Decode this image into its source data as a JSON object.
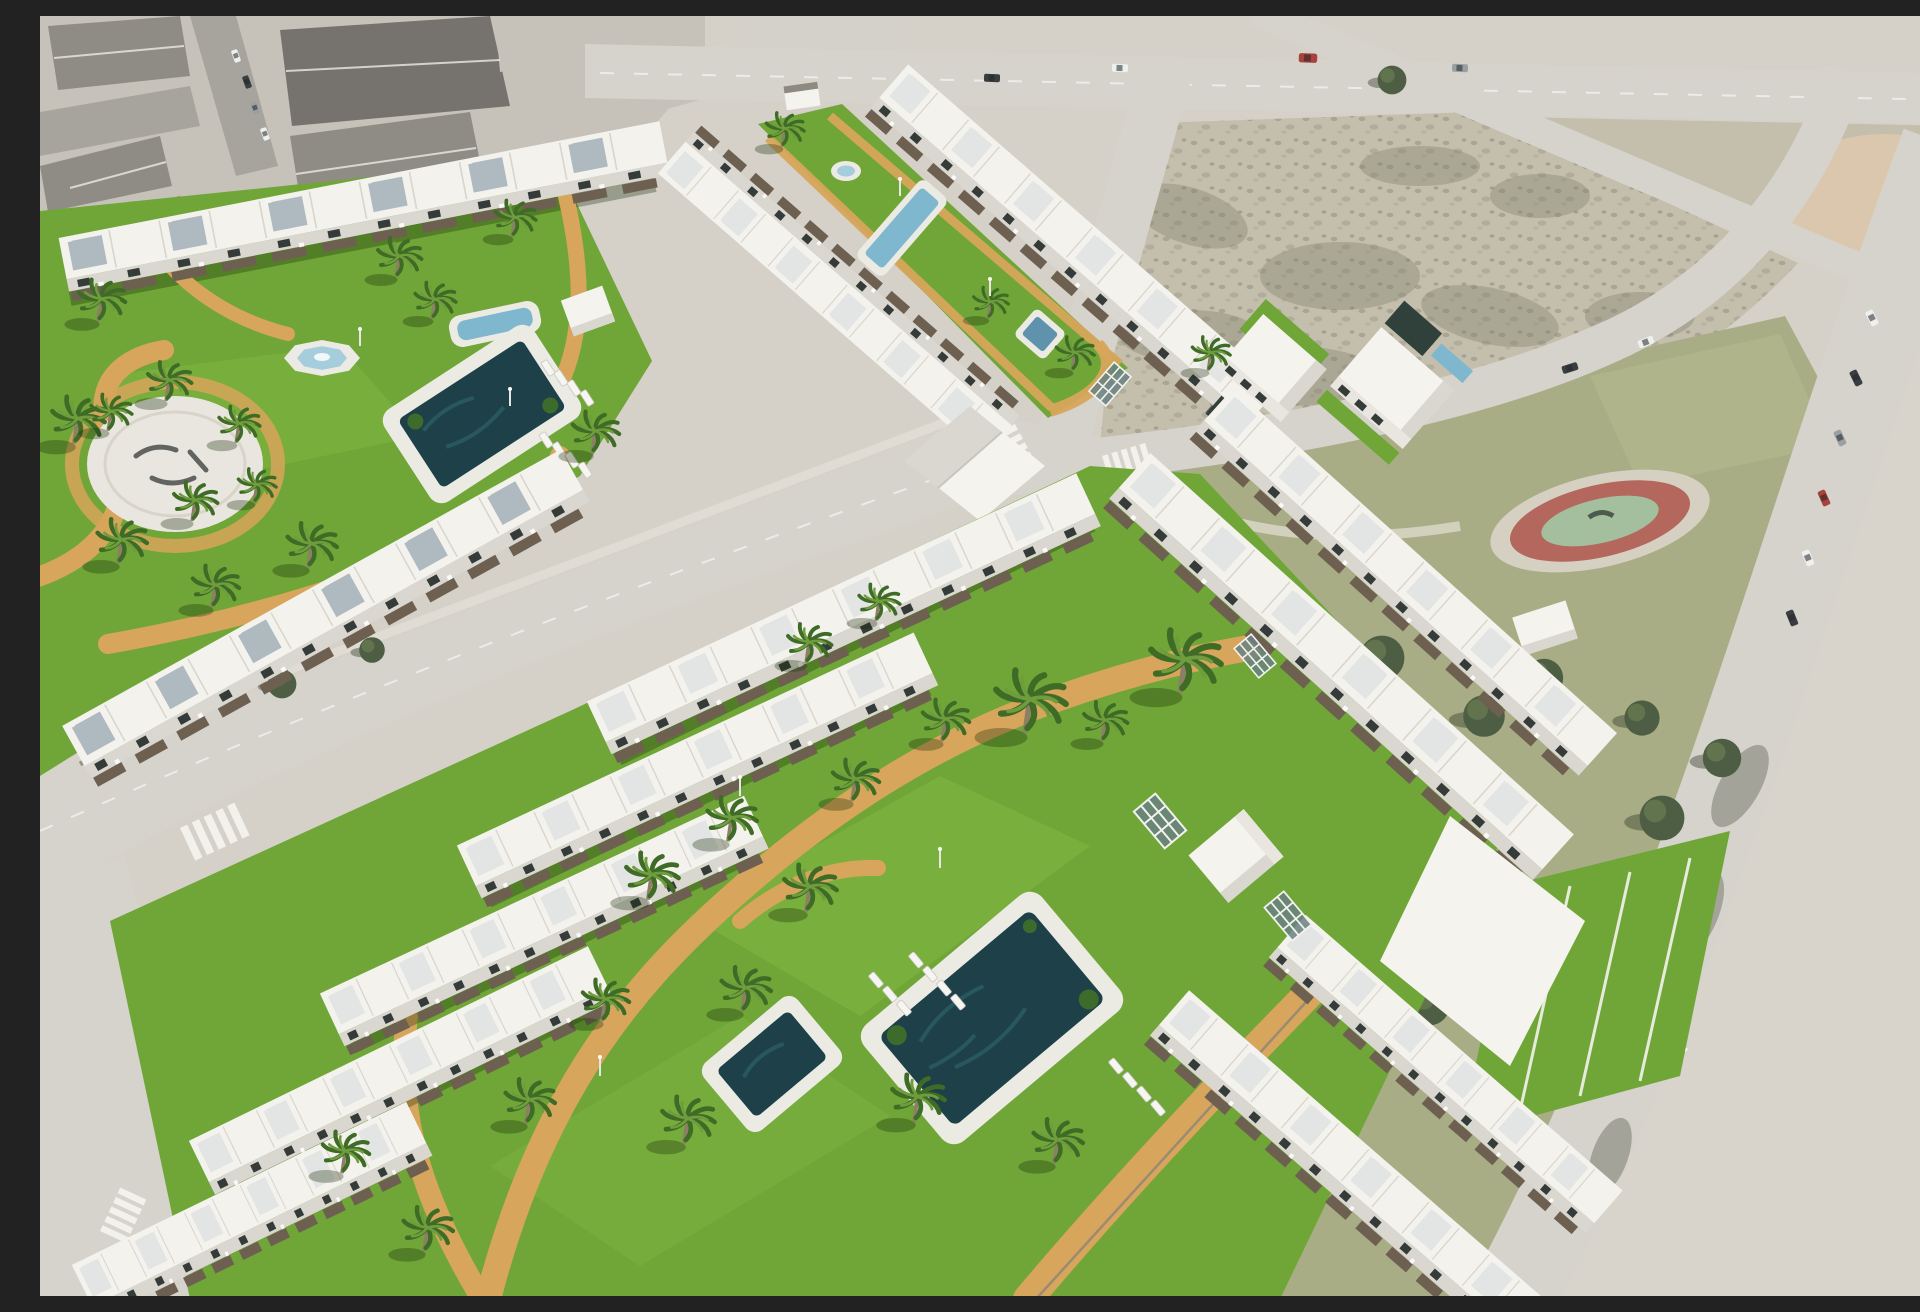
{
  "meta": {
    "title": "Aerial 3D architectural render of a new-build residential development composited over an aerial photo of an existing coastal town",
    "image_type": "architectural-visualisation",
    "width_px": 1920,
    "height_px": 1280
  },
  "palette": {
    "base": "#d5d1c8",
    "town_dark": "#76736e",
    "town_mid": "#8f8c86",
    "town_light": "#c6c2ba",
    "town_white": "#d4d1ca",
    "road_photo": "#a7a49e",
    "road": "#d6d3cc",
    "curb": "#eceae4",
    "dirt": "#c4bead",
    "dirt_dark": "#81806c",
    "sand": "#dbc7ad",
    "park_grass": "#a9ad85",
    "park_grass_light": "#b6b98f",
    "tree_dark": "#4e5e44",
    "tree_light": "#66784f",
    "tree_shadow": "rgba(45,55,38,0.40)",
    "grass": "#6fa637",
    "grass_light": "#8cc04a",
    "path": "#d7a55b",
    "roof": "#f3f2ed",
    "roof_line": "#d8d5cd",
    "panel": "#e3e5e4",
    "panel_blue": "#aeb9c0",
    "facade": "#d9d7d0",
    "opening": "#343b38",
    "pergola": "#6e6051",
    "wall_stone": "#9d9384",
    "wall_brick": "#9b6f60",
    "deck": "#ebeae3",
    "pool_dark": "#1d4049",
    "pool_teal": "#2e6368",
    "pool_blue": "#7fb7cf",
    "pool_pale": "#a5cddb",
    "structure": "#f4f3ee",
    "structure_side": "#d9d7d0",
    "structure_front": "#e8e6df",
    "glass": "#6a8180",
    "trunk": "#8d7f66",
    "frond": "#3e6b26",
    "frond_light": "#6f9c3c",
    "lounger": "#f6f5f1",
    "zebra": "#f4f3ee",
    "car_red": "#a8423c",
    "car_white": "#eef0ee",
    "car_dark": "#3a3e41",
    "car_gray": "#9aa0a2",
    "shadow": "rgba(25,45,10,0.32)",
    "road_shadow": "rgba(70,75,60,0.35)"
  },
  "scene": {
    "photo_context": {
      "label": "existing town, vacant plots, park and roads (aerial photo, desaturated)",
      "features": [
        "pitched-roof town blocks (top-left)",
        "street with parked cars",
        "large vacant scrub plot (top-right)",
        "pink sand patch (far top-right)",
        "public park with dense pine trees",
        "circular playground with red track and green centre",
        "small white utility building in park",
        "road with parked cars and white lane arrow (right edge)",
        "zebra crosswalks"
      ]
    },
    "development": {
      "label": "new-build complexes (crisp white 3D render)",
      "complexes": [
        {
          "name": "northwest-complex",
          "buildings": "two rows of two-storey white townhouses with blue-grey roof panels and brick garden walls",
          "amenities": [
            "octagonal fountain",
            "rounded spa pool",
            "main swimming pool with dark water",
            "white circular plaza with ground logo marks",
            "white cube pavilion",
            "sun loungers",
            "palm garden",
            "sand-coloured winding paths"
          ]
        },
        {
          "name": "north-strip-complex",
          "buildings": "two parallel townhouse rows flanking a long linear lawn",
          "amenities": [
            "round fountain",
            "lap pool",
            "small kids pool",
            "small pavilion hut",
            "perimeter paths"
          ]
        },
        {
          "name": "detached-villas",
          "buildings": "two detached two-storey villas by the park",
          "amenities": [
            "dark private plunge pools",
            "blue lap pool",
            "private lawns"
          ]
        },
        {
          "name": "south-complex",
          "buildings": "terraced apartment rows with roof terraces and dark pergolas around a large shared garden",
          "amenities": [
            "main pool with dark water and white deck",
            "secondary pool",
            "sun loungers",
            "white cube pavilion",
            "glass trellis skylights",
            "palm lawns",
            "curving sand paths"
          ]
        }
      ]
    },
    "counts": {
      "render_palm_trees": 36,
      "park_trees": 22,
      "sun_loungers": 19,
      "cars": 16,
      "zebra_crosswalks": 4,
      "pools_and_fountains": 11,
      "glass_trellises": 4,
      "pavilions": 4,
      "playgrounds": 1
    }
  }
}
